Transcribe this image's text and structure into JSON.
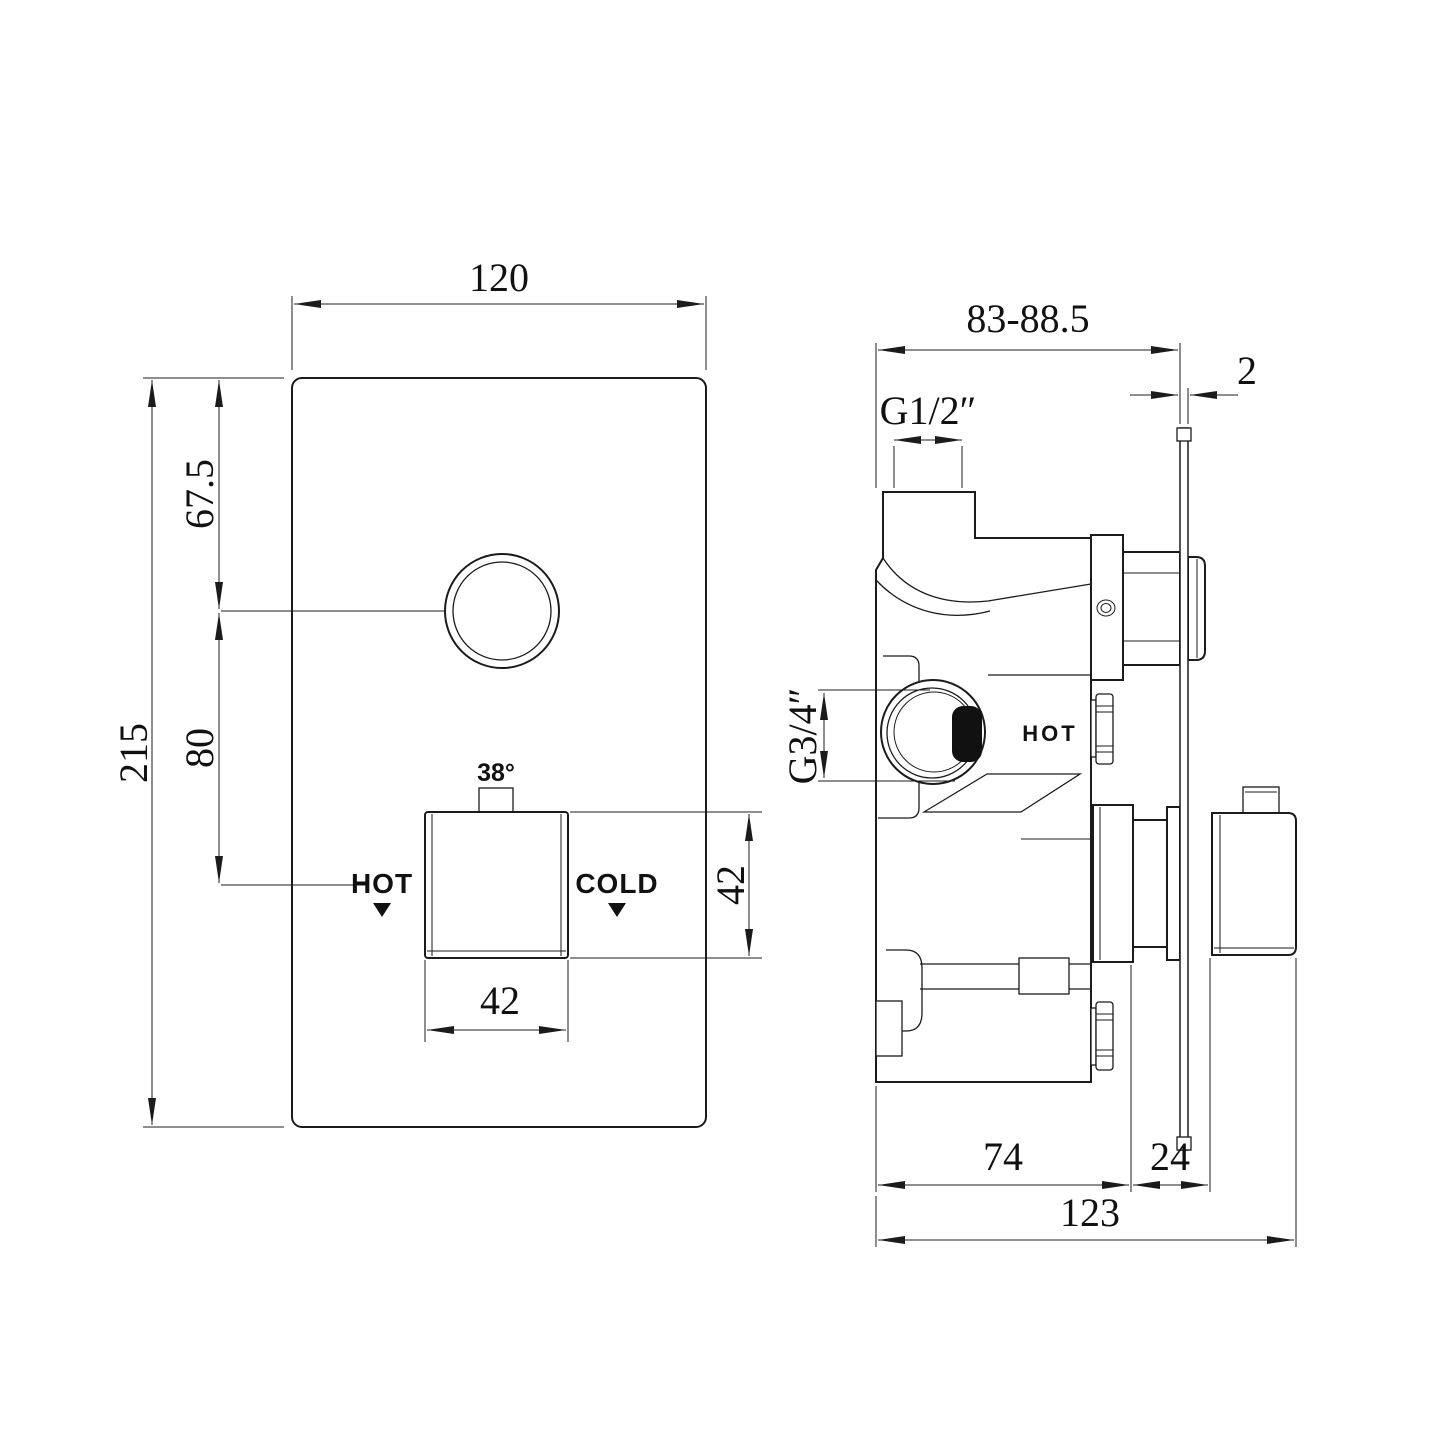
{
  "drawing_type": "thermostatic shower valve installation dimension drawing",
  "front_view": {
    "width_mm": "120",
    "height_mm": "215",
    "button_offset_mm": "67.5",
    "button_to_knob_mm": "80",
    "knob_width_mm": "42",
    "knob_height_mm": "42",
    "temp_stop_label": "38°",
    "hot_label": "HOT",
    "cold_label": "COLD"
  },
  "side_view": {
    "depth_range_mm": "83-88.5",
    "plate_thickness_mm": "2",
    "inlet_thread": "G1/2″",
    "port_thread": "G3/4″",
    "hot_label": "HOT",
    "body_depth_mm": "74",
    "handle_depth_mm": "24",
    "total_depth_mm": "123"
  },
  "colors": {
    "line": "#1b1b1b",
    "background": "#ffffff"
  }
}
